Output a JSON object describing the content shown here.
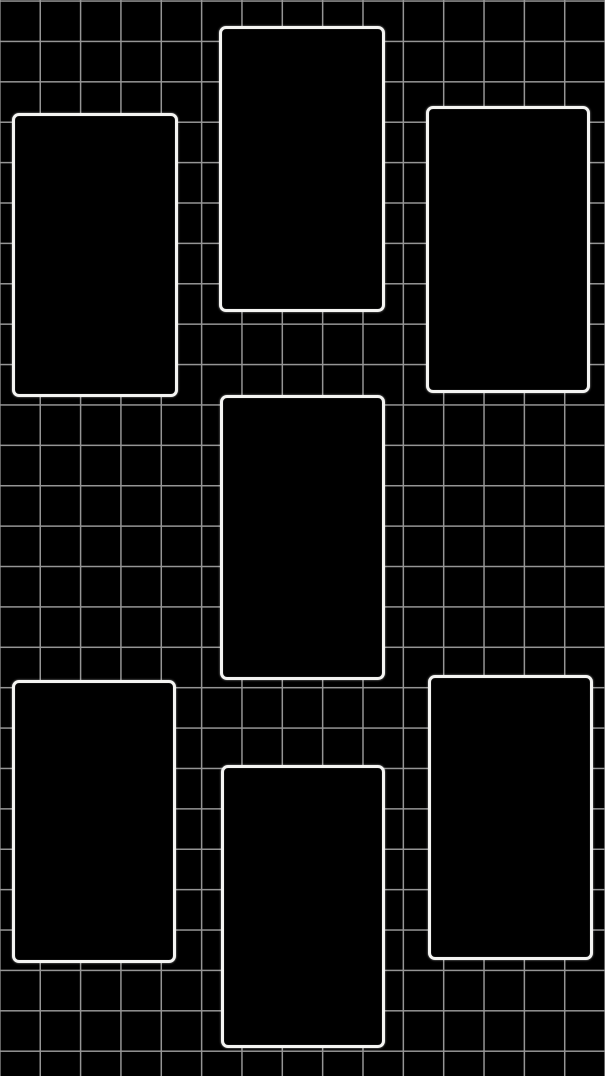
{
  "canvas": {
    "width_px": 605,
    "height_px": 1076,
    "background_color": "#000000"
  },
  "grid": {
    "cell_size_px": 40.4,
    "line_color": "#b6b6b6",
    "line_width_px": 1.4
  },
  "frames": {
    "border_color": "#f4f4f2",
    "fill_color": "#000000",
    "border_width_px": 3.5,
    "corner_radius_px": 7,
    "items": [
      {
        "name": "frame-top-left",
        "x": 12,
        "y": 113,
        "width": 166,
        "height": 284
      },
      {
        "name": "frame-top-center",
        "x": 219,
        "y": 26,
        "width": 166,
        "height": 286
      },
      {
        "name": "frame-top-right",
        "x": 426,
        "y": 106,
        "width": 164,
        "height": 287
      },
      {
        "name": "frame-middle-center",
        "x": 220,
        "y": 395,
        "width": 165,
        "height": 285
      },
      {
        "name": "frame-bottom-left",
        "x": 12,
        "y": 680,
        "width": 164,
        "height": 283
      },
      {
        "name": "frame-bottom-center",
        "x": 221,
        "y": 765,
        "width": 164,
        "height": 283
      },
      {
        "name": "frame-bottom-right",
        "x": 428,
        "y": 675,
        "width": 165,
        "height": 285
      }
    ]
  }
}
